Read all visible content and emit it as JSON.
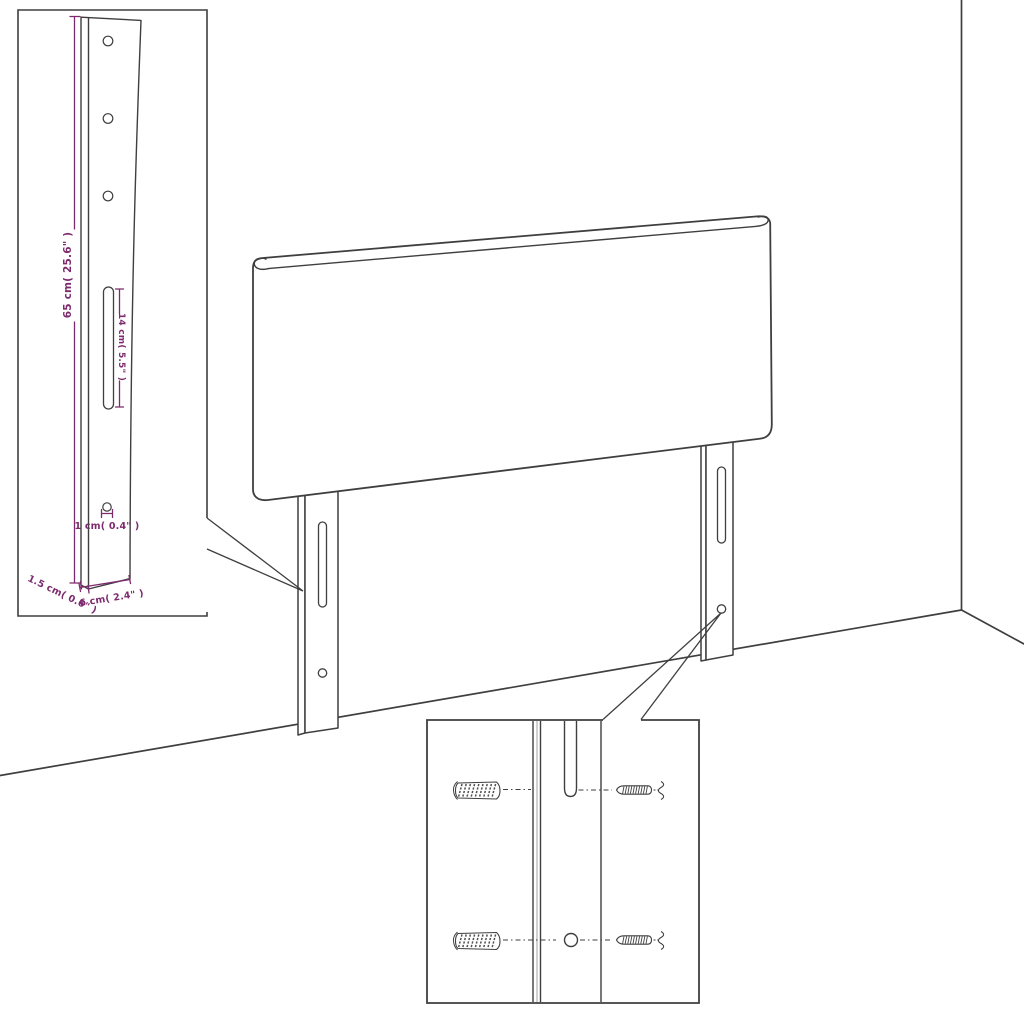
{
  "diagram": {
    "subject": "headboard-with-mounting-brackets-dimension-diagram",
    "colors": {
      "line": "#3f3f3f",
      "dimension": "#7d2b6e",
      "background": "#ffffff"
    },
    "detail_inset": {
      "dimensions": {
        "bracket_height": "65 cm( 25.6\" )",
        "slot_length": "14 cm( 5.5\" )",
        "hole_diameter": "1 cm( 0.4\" )",
        "bracket_thickness": "1.5 cm( 0.6\" )",
        "bracket_width": "6 cm( 2.4\" )"
      }
    }
  }
}
